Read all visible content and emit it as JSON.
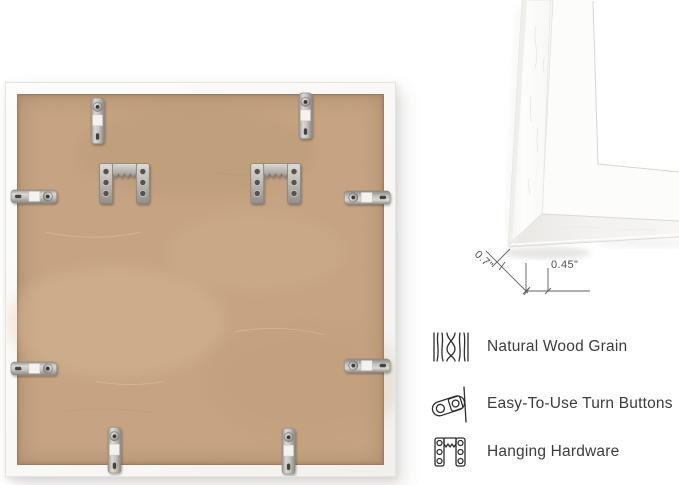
{
  "view": {
    "name": "White picture frame product detail image",
    "back_view": "frame back with hardware",
    "corner_view": "frame corner profile with measurements"
  },
  "dimensions": {
    "depth": "0.7\"",
    "face_width": "0.45\""
  },
  "features": [
    {
      "icon": "wood-grain-icon",
      "label": "Natural Wood Grain"
    },
    {
      "icon": "turn-button-icon",
      "label": "Easy-To-Use Turn Buttons"
    },
    {
      "icon": "hanging-hardware-icon",
      "label": "Hanging Hardware"
    }
  ],
  "hardware": {
    "turn_button_count": 8,
    "sawtooth_hanger_count": 2
  },
  "colors": {
    "backing_board": "#c6a483",
    "frame_white": "#fafaf8",
    "metal": "#b9b6b1",
    "text": "#3c3c3c",
    "dimension_lines": "#5f5f5f"
  }
}
